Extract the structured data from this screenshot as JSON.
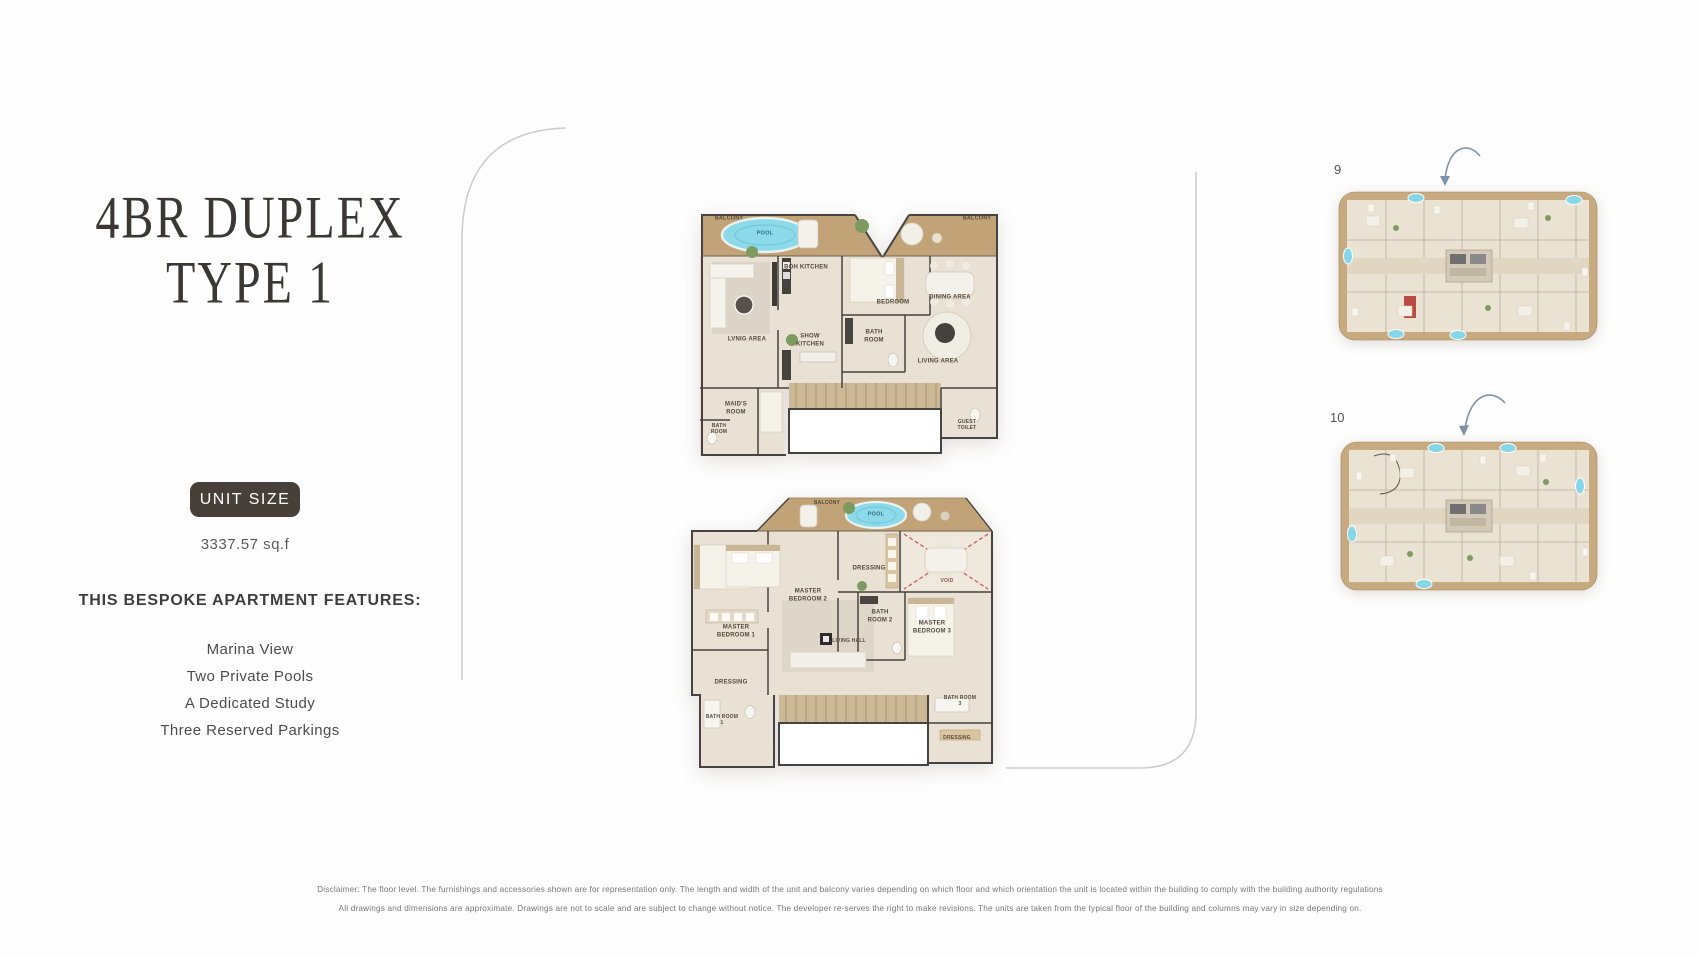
{
  "left_panel": {
    "title_line1": "4BR DUPLEX",
    "title_line2": "TYPE 1",
    "unit_size_label": "UNIT SIZE",
    "unit_size_value": "3337.57 sq.f",
    "features_heading": "THIS BESPOKE APARTMENT FEATURES:",
    "features": [
      "Marina View",
      "Two Private Pools",
      "A Dedicated Study",
      "Three Reserved Parkings"
    ]
  },
  "upper_plan": {
    "labels": {
      "balcony_left": "BALCONY",
      "pool": "POOL",
      "boh_kitchen": "BOH KITCHEN",
      "bedroom": "BEDROOM",
      "balcony_right": "BALCONY",
      "dining_area": "DINING AREA",
      "living_area": "LIVING AREA",
      "show_kitchen": "SHOW KITCHEN",
      "bath_room": "BATH ROOM",
      "lvnig_area": "LVNIG AREA",
      "maids_room": "MAID'S ROOM",
      "maid_bath_room": "BATH ROOM",
      "guest_toilet": "GUEST TOILET"
    }
  },
  "lower_plan": {
    "labels": {
      "balcony": "BALCONY",
      "pool": "POOL",
      "master_bedroom_1": "MASTER BEDROOM 1",
      "master_bedroom_2": "MASTER BEDROOM 2",
      "dressing_top": "DRESSING",
      "bath_room_2": "BATH ROOM 2",
      "void": "VOID",
      "master_bedroom_3": "MASTER BEDROOM 3",
      "living_hall": "LIVING HALL",
      "dressing_left": "DRESSING",
      "bath_room_1": "BATH ROOM 1",
      "bath_room_3": "BATH ROOM 3",
      "dressing_right": "DRESSING"
    }
  },
  "key_plans": {
    "plate_9": {
      "label": "9"
    },
    "plate_10": {
      "label": "10"
    }
  },
  "disclaimer": {
    "line1": "Disclaimer: The floor level. The furnishings and accessories shown are for representation only. The length and width of the unit and balcony varies depending on which floor and which orientation the unit is located within the building to comply with the building authority regulations",
    "line2": "All drawings and dimensions are approximate. Drawings are not to scale and are subject to change without notice. The developer re-serves the right to make revisions. The units are taken from the typical floor of the building and columns may vary in size depending on."
  },
  "colors": {
    "badge_bg": "#474038",
    "title_text": "#3b3833",
    "pool_blue": "#8cd9e9",
    "wood": "#c2a277",
    "floor": "#e9e1d3",
    "wall": "#474340",
    "void_red": "#cf4f55",
    "arrow_blue": "#7d93ab"
  }
}
